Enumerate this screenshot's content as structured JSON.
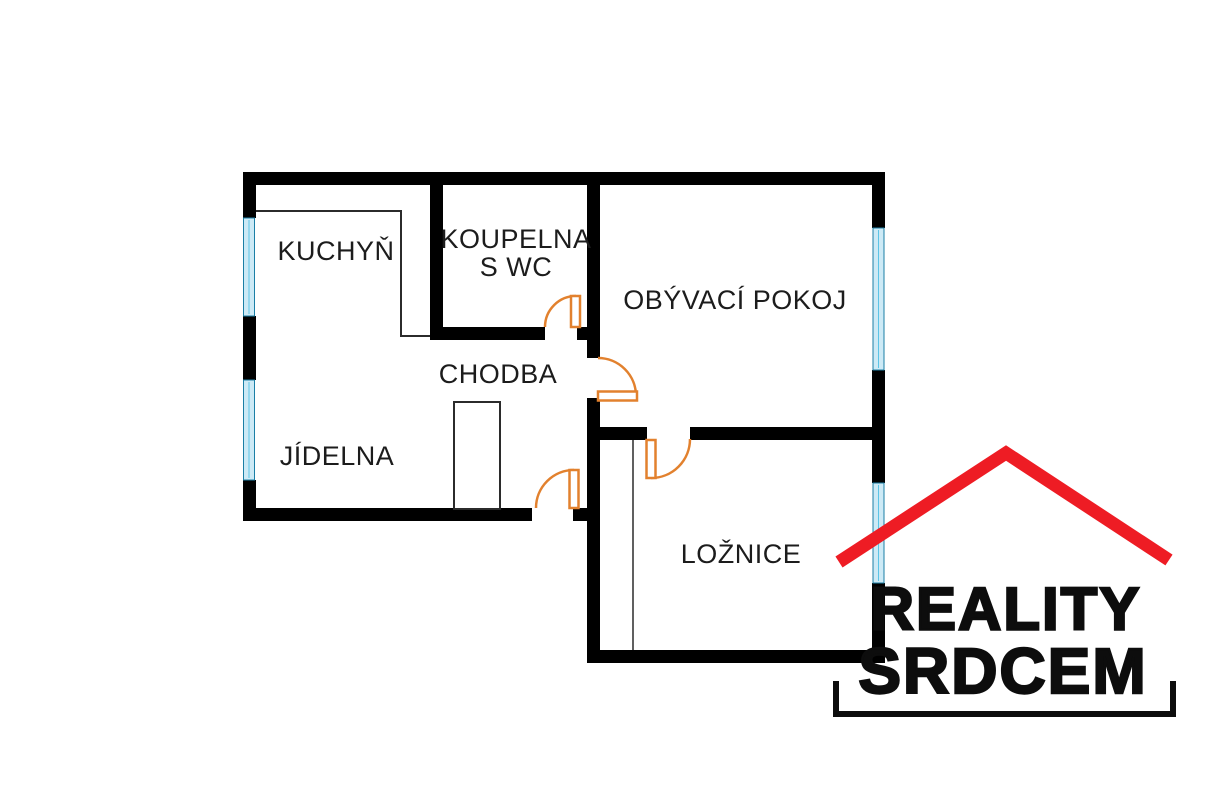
{
  "floor_plan": {
    "rooms": {
      "kuchyn": {
        "label": "KUCHYŇ"
      },
      "koupelna": {
        "label_line1": "KOUPELNA",
        "label_line2": "S WC"
      },
      "obyvaci_pokoj": {
        "label": "OBÝVACÍ POKOJ"
      },
      "chodba": {
        "label": "CHODBA"
      },
      "jidelna": {
        "label": "JÍDELNA"
      },
      "loznice": {
        "label": "LOŽNICE"
      }
    },
    "colors": {
      "wall": "#000000",
      "door_swing": "#e2812e",
      "window_fill": "#cdeaf6",
      "window_frame": "#1b7fa6"
    }
  },
  "logo": {
    "line1": "REALITY",
    "line2": "SRDCEM",
    "roof_color": "#ee1c24",
    "text_color": "#0d0d0d"
  }
}
